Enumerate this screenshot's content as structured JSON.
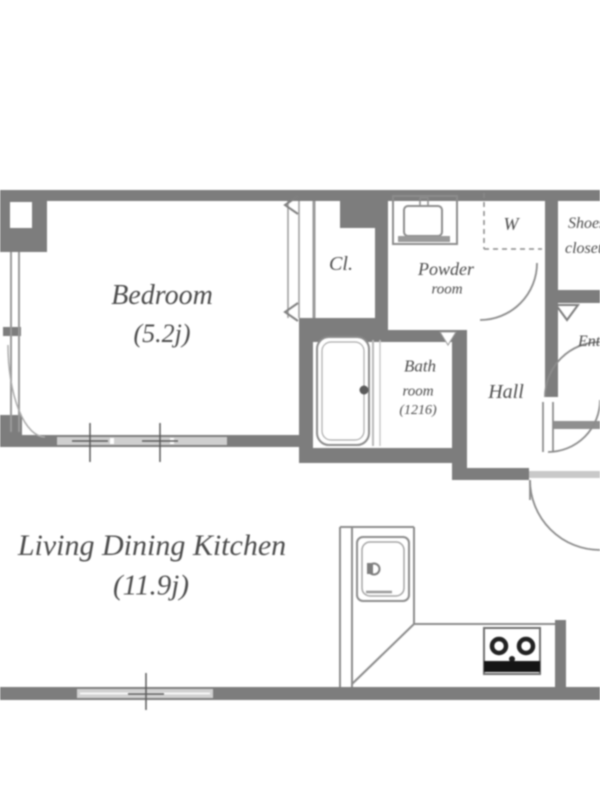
{
  "plan": {
    "bedroom": {
      "name": "Bedroom",
      "area": "(5.2j)"
    },
    "ldk": {
      "name": "Living Dining Kitchen",
      "area": "(11.9j)"
    },
    "closet": {
      "abbr": "Cl."
    },
    "powder_room": {
      "line1": "Powder",
      "line2": "room"
    },
    "washer": {
      "abbr": "W"
    },
    "shoes_closet": {
      "line1": "Shoes",
      "line2": "closet"
    },
    "bathroom": {
      "line1": "Bath",
      "line2": "room",
      "size": "(1216)"
    },
    "hall": {
      "name": "Hall"
    },
    "entrance": {
      "name": "Entrance"
    }
  },
  "colors": {
    "wall": "#7d7d7d",
    "line": "#8c8c8c",
    "light_door": "#cfcfcf",
    "text": "#4c4c4c",
    "stove": "#151515",
    "background": "#ffffff"
  }
}
